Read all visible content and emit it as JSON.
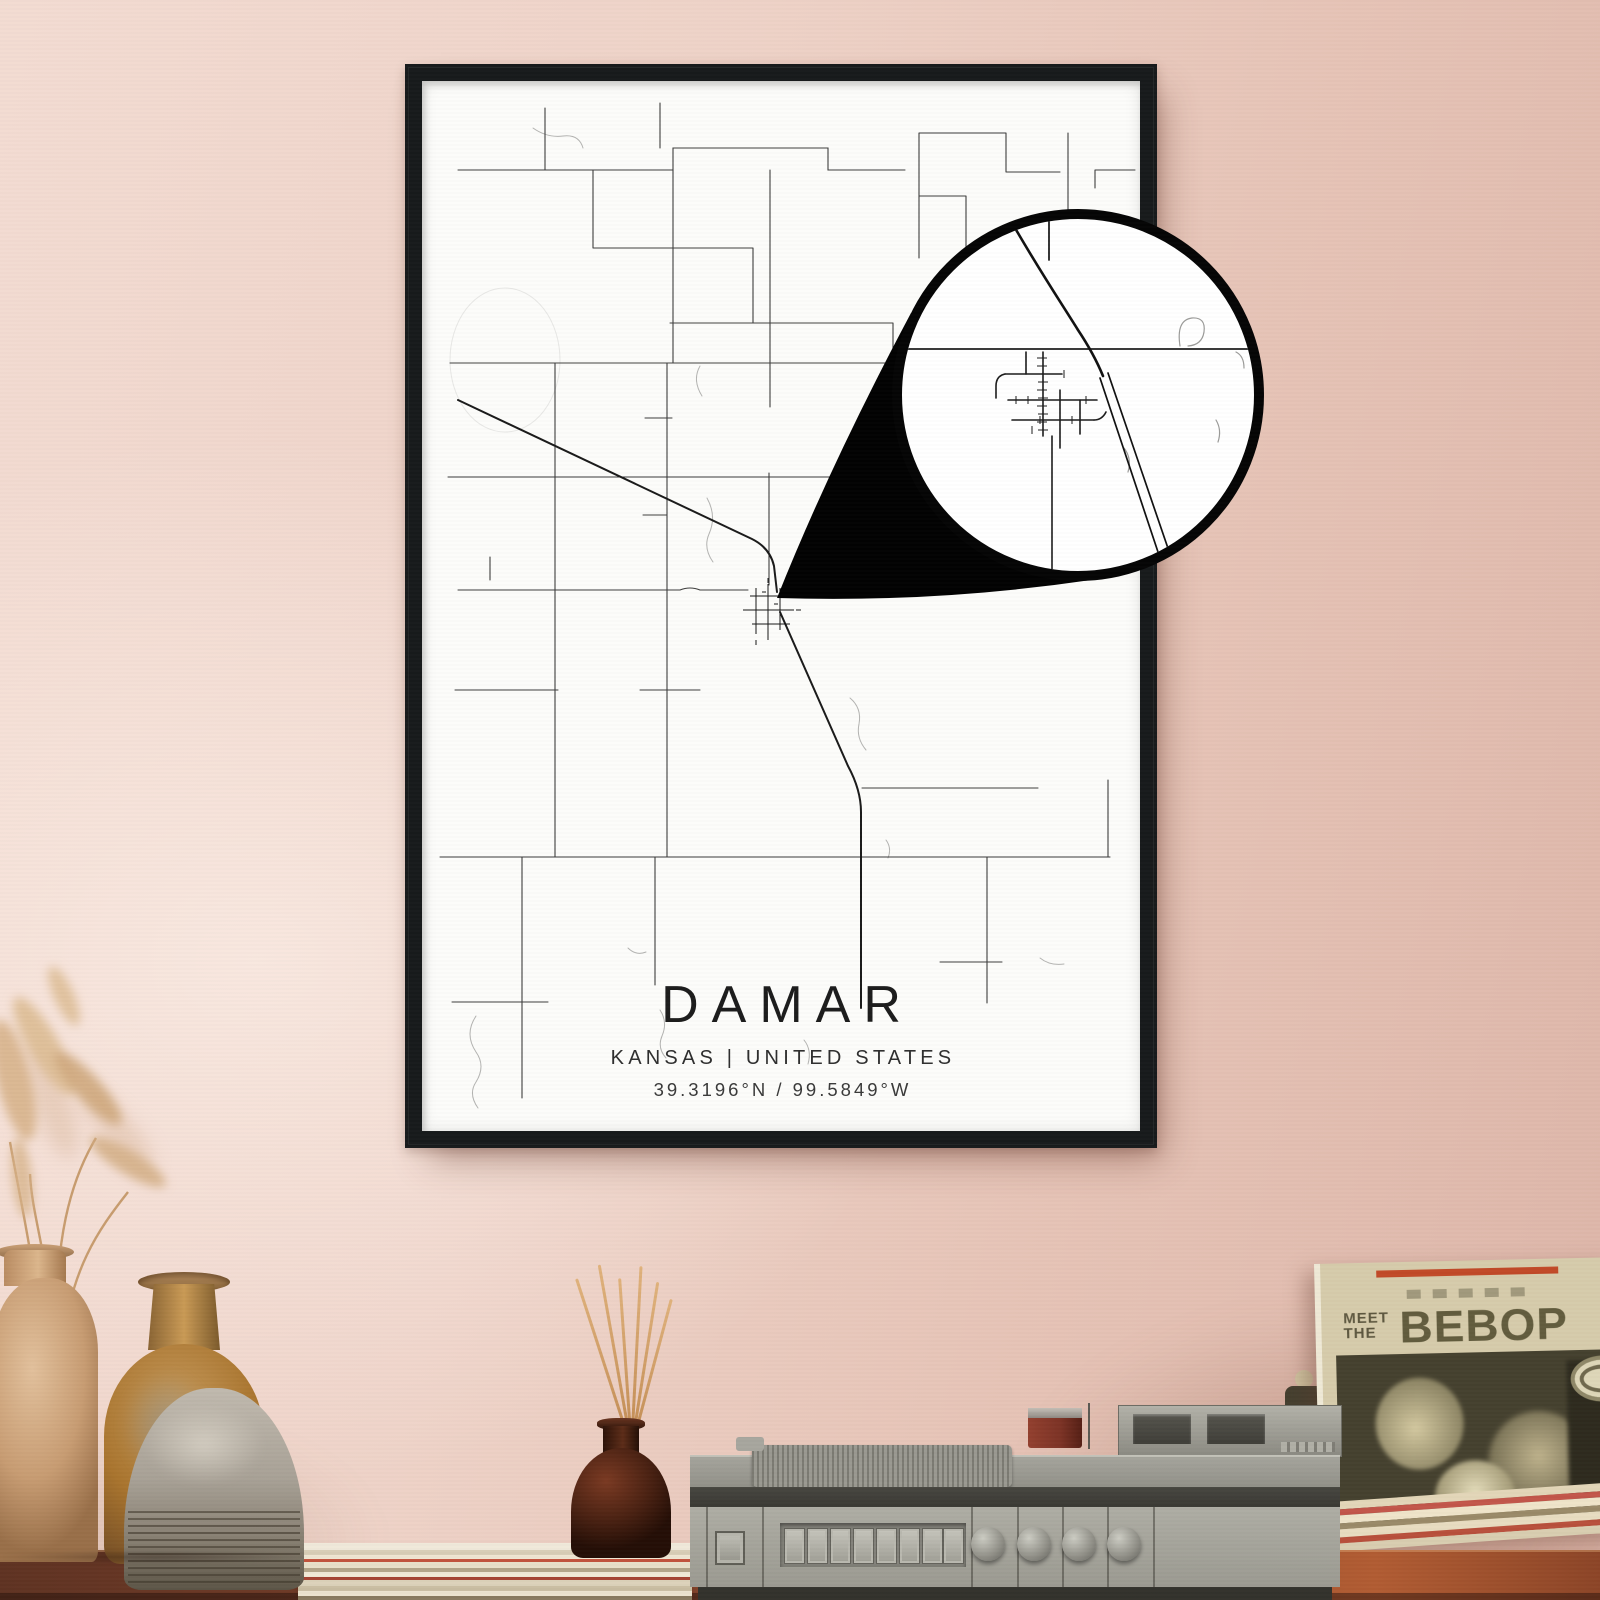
{
  "poster": {
    "title": "DAMAR",
    "subtitle": "KANSAS | UNITED STATES",
    "coordinates": "39.3196°N / 99.5849°W",
    "frame_color": "#171a1b",
    "paper_color": "#fcfcfa",
    "road_color": "#3d3d3d",
    "highway_color": "#1a1a1a",
    "water_color": "#b3b3b1",
    "callout_fill": "#020202"
  },
  "record_sleeve": {
    "header_small_top": "MEET",
    "header_small_bottom": "THE",
    "header_large": "BEBOP",
    "header_color": "#5e5840",
    "sleeve_color": "#d6cbab",
    "accent_stripe_color": "#c14a28"
  },
  "room": {
    "wall_color_top_right": "#ddb5a8",
    "wall_color_bottom_left": "#f3dcd2",
    "table_color": "#7d4029",
    "record_player_color": "#a3a29a",
    "diffuser_color": "#4a2112",
    "vase_left_color": "#c79c72",
    "vase_middle_color": "#a9742e",
    "vase_front_color": "#a8a196",
    "pampas_color": "#d8b48c"
  }
}
